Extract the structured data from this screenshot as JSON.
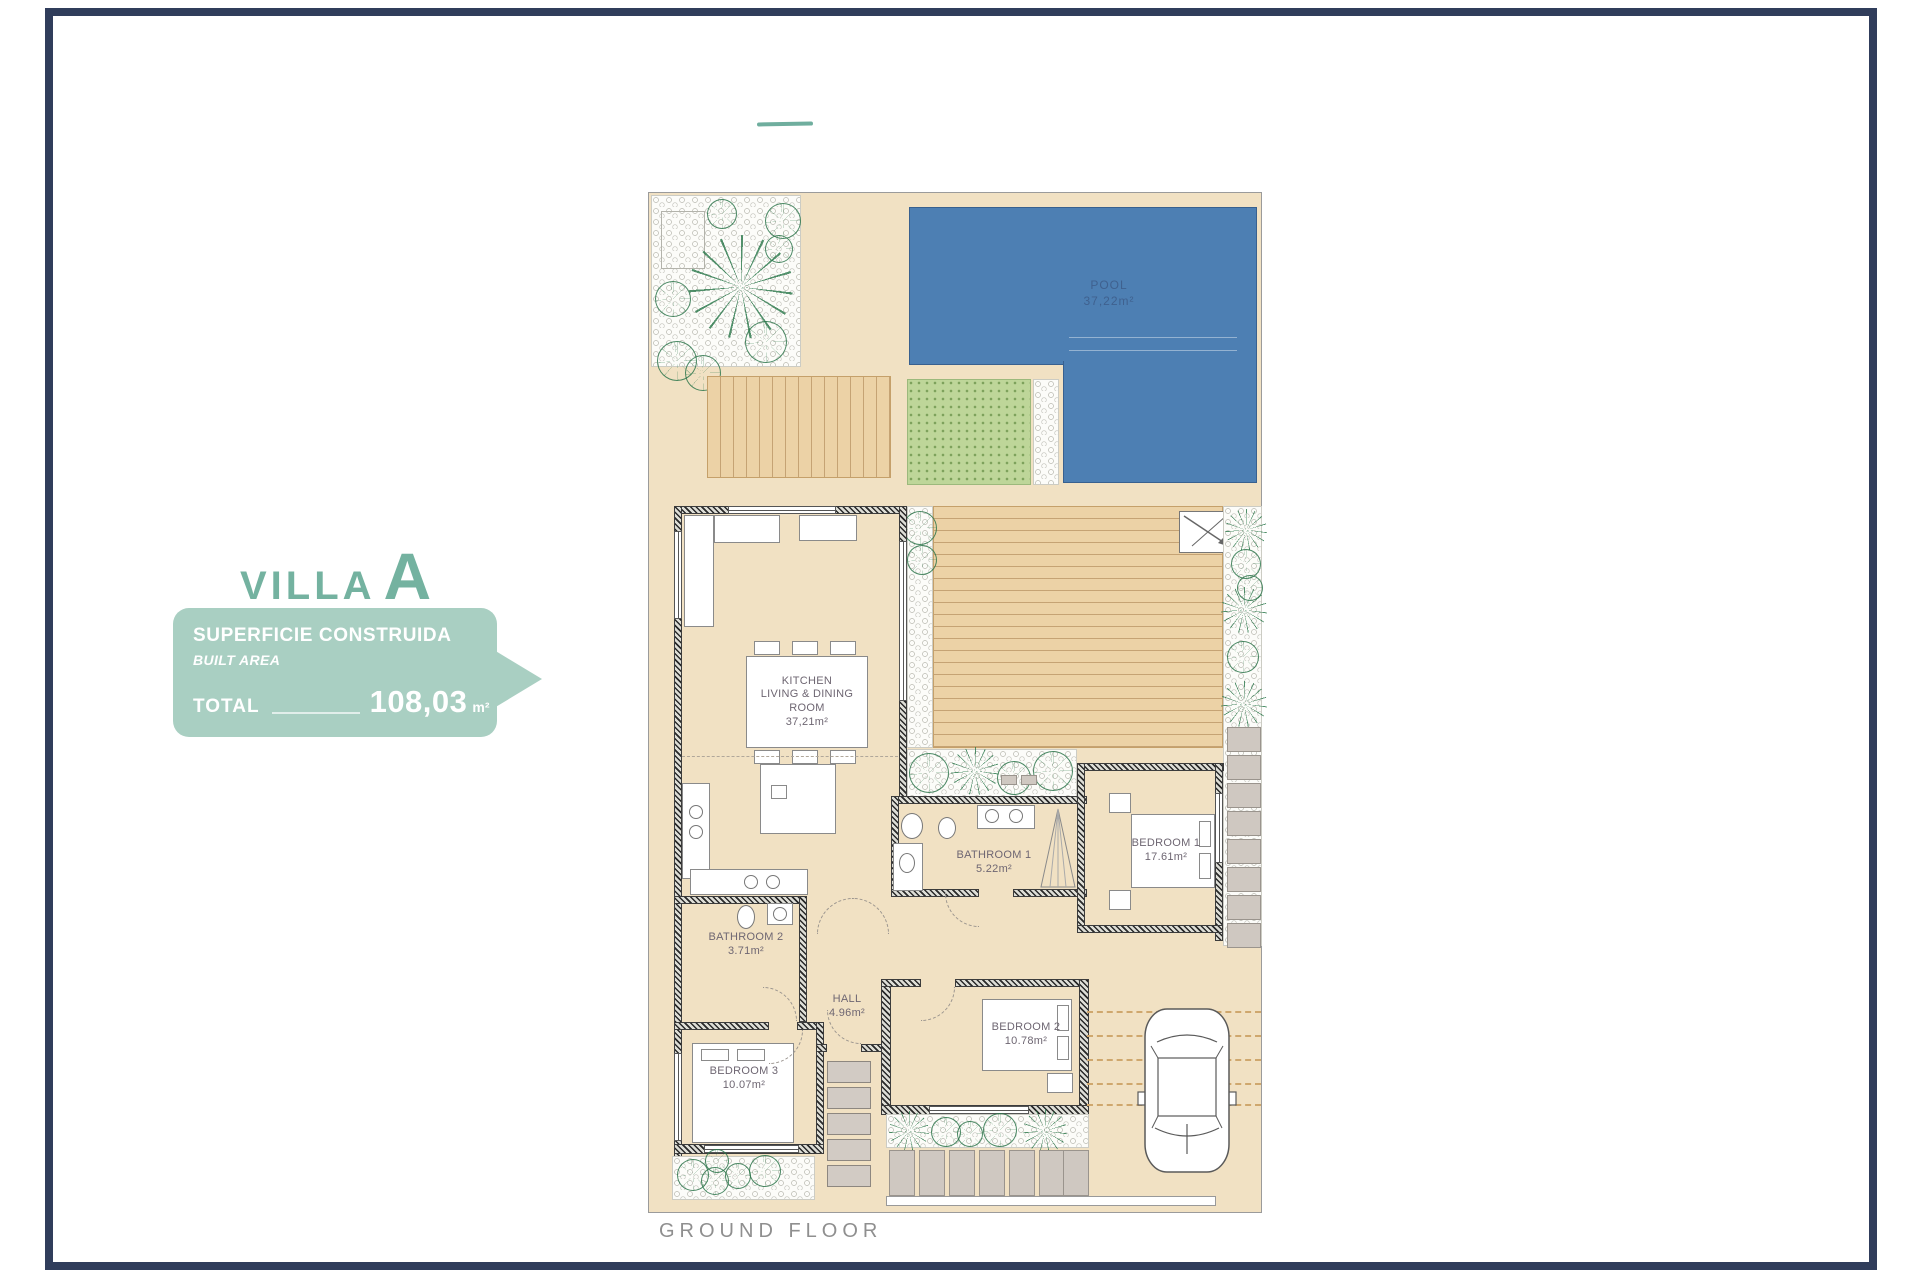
{
  "page": {
    "frame_color": "#303d5b",
    "background": "#ffffff"
  },
  "branding": {
    "villa_word": "VILLA",
    "villa_letter": "A",
    "accent_color": "#74b2a0",
    "panel_color": "#a9cfc2",
    "panel": {
      "title": "SUPERFICIE CONSTRUIDA",
      "subtitle": "BUILT AREA",
      "total_label": "TOTAL",
      "total_value": "108,03",
      "total_unit": "m²"
    }
  },
  "plan": {
    "footer_label": "GROUND FLOOR",
    "pool": {
      "name": "POOL",
      "area": "37,22m²",
      "water_color": "#4d7fb3"
    },
    "rooms": {
      "kitchen": {
        "line1": "KITCHEN",
        "line2": "LIVING & DINING",
        "line3": "ROOM",
        "area": "37,21m²"
      },
      "bathroom1": {
        "name": "BATHROOM 1",
        "area": "5.22m²"
      },
      "bedroom1": {
        "name": "BEDROOM 1",
        "area": "17.61m²"
      },
      "bathroom2": {
        "name": "BATHROOM 2",
        "area": "3.71m²"
      },
      "hall": {
        "name": "HALL",
        "area": "4.96m²"
      },
      "bedroom2": {
        "name": "BEDROOM 2",
        "area": "10.78m²"
      },
      "bedroom3": {
        "name": "BEDROOM 3",
        "area": "10.07m²"
      }
    }
  }
}
